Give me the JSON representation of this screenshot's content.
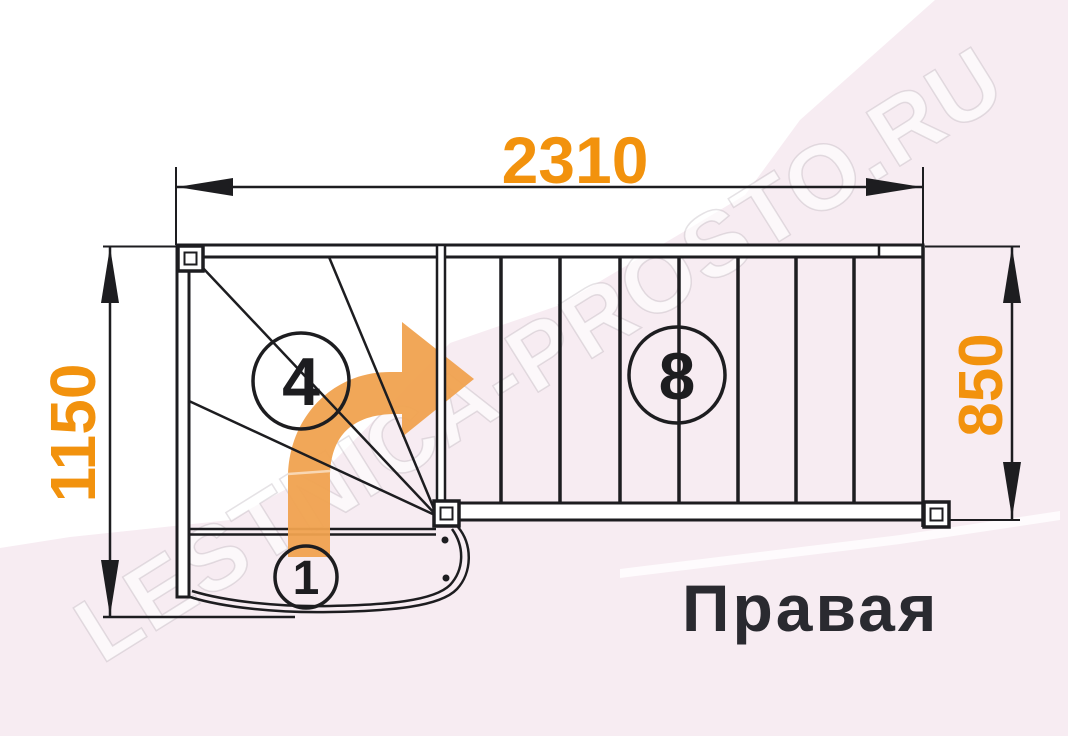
{
  "label": {
    "text": "Правая"
  },
  "dimensions": {
    "top": "2310",
    "left": "1150",
    "right": "850"
  },
  "steps": {
    "winder": "4",
    "straight": "8",
    "first": "1"
  },
  "watermark": {
    "text": "LESTNICA-PROSTO.RU"
  },
  "arrow": {
    "name": "turn-right-arrow",
    "direction": "up-then-right",
    "color": "#f0a24f"
  },
  "colors": {
    "dimension_text": "#f2920d",
    "line": "#1d1d20",
    "pink_band": "#f7ecf2",
    "label_text": "#2a2a30"
  }
}
